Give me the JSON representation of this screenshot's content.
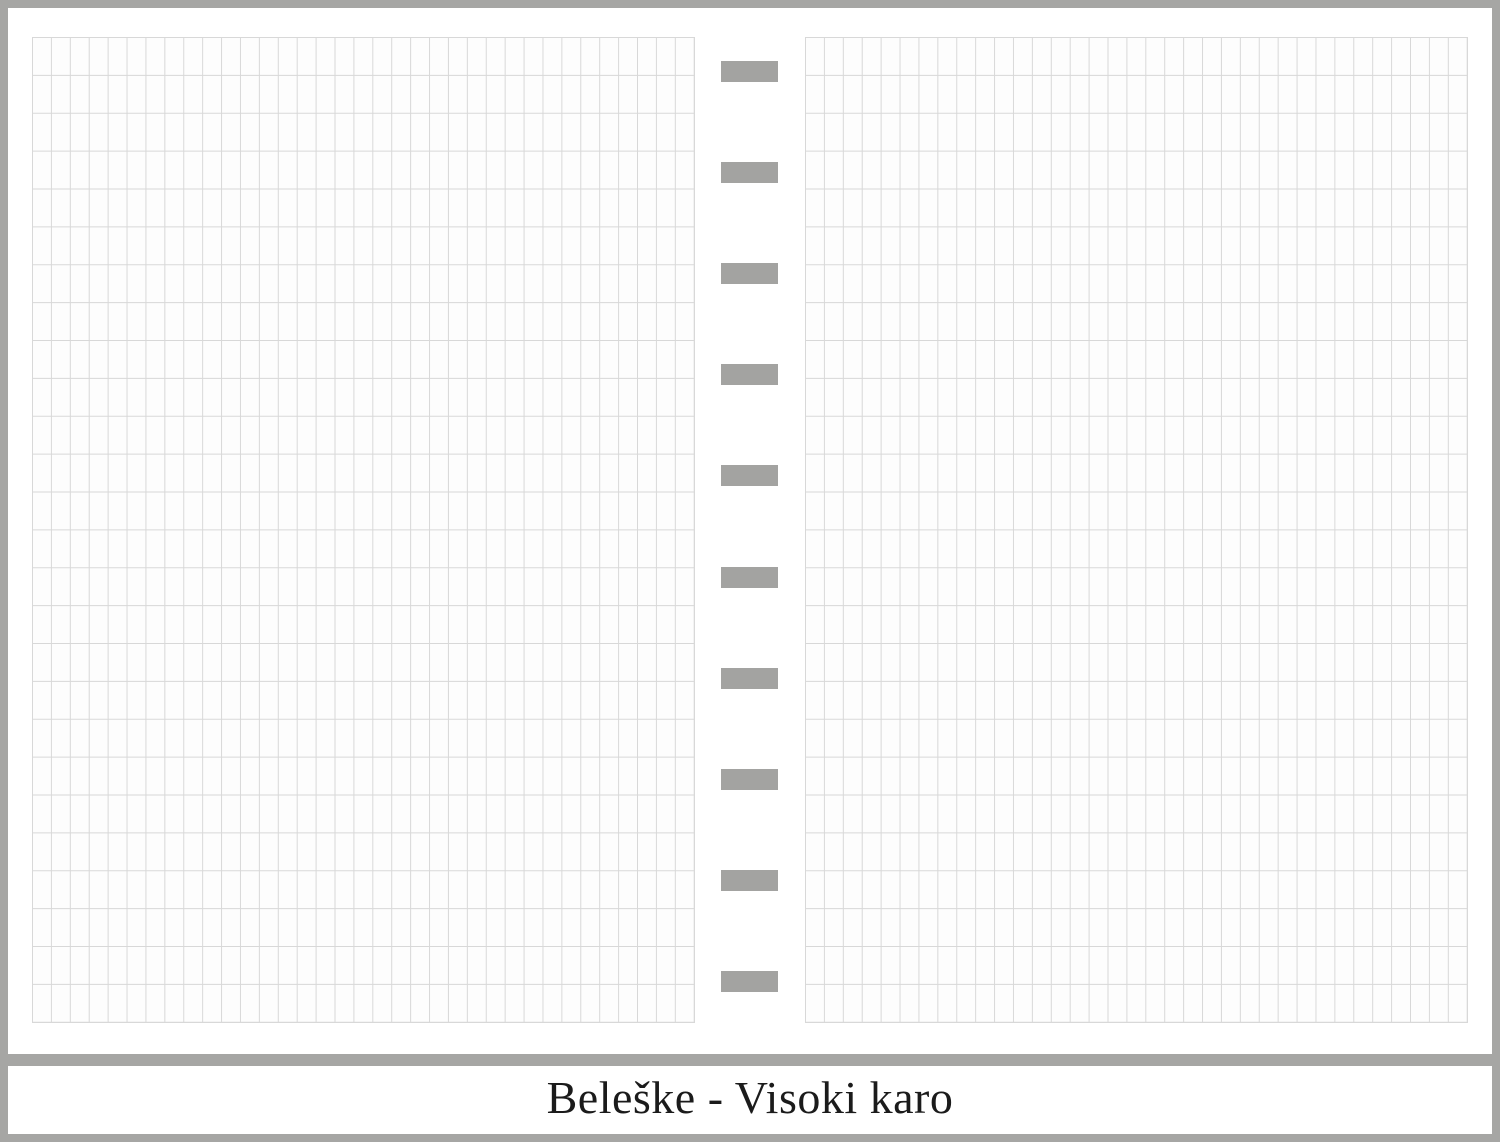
{
  "footer": {
    "title": "Beleške - Visoki karo"
  },
  "binding": {
    "tab_count": 10
  },
  "grid": {
    "columns": 35,
    "rows": 26
  },
  "colors": {
    "frame_gray": "#a6a6a4",
    "tab_gray": "#a3a3a1",
    "grid_line": "#d8d8d8",
    "page_bg": "#fdfdfd",
    "title_color": "#1b1b1b",
    "bg": "#ffffff"
  }
}
